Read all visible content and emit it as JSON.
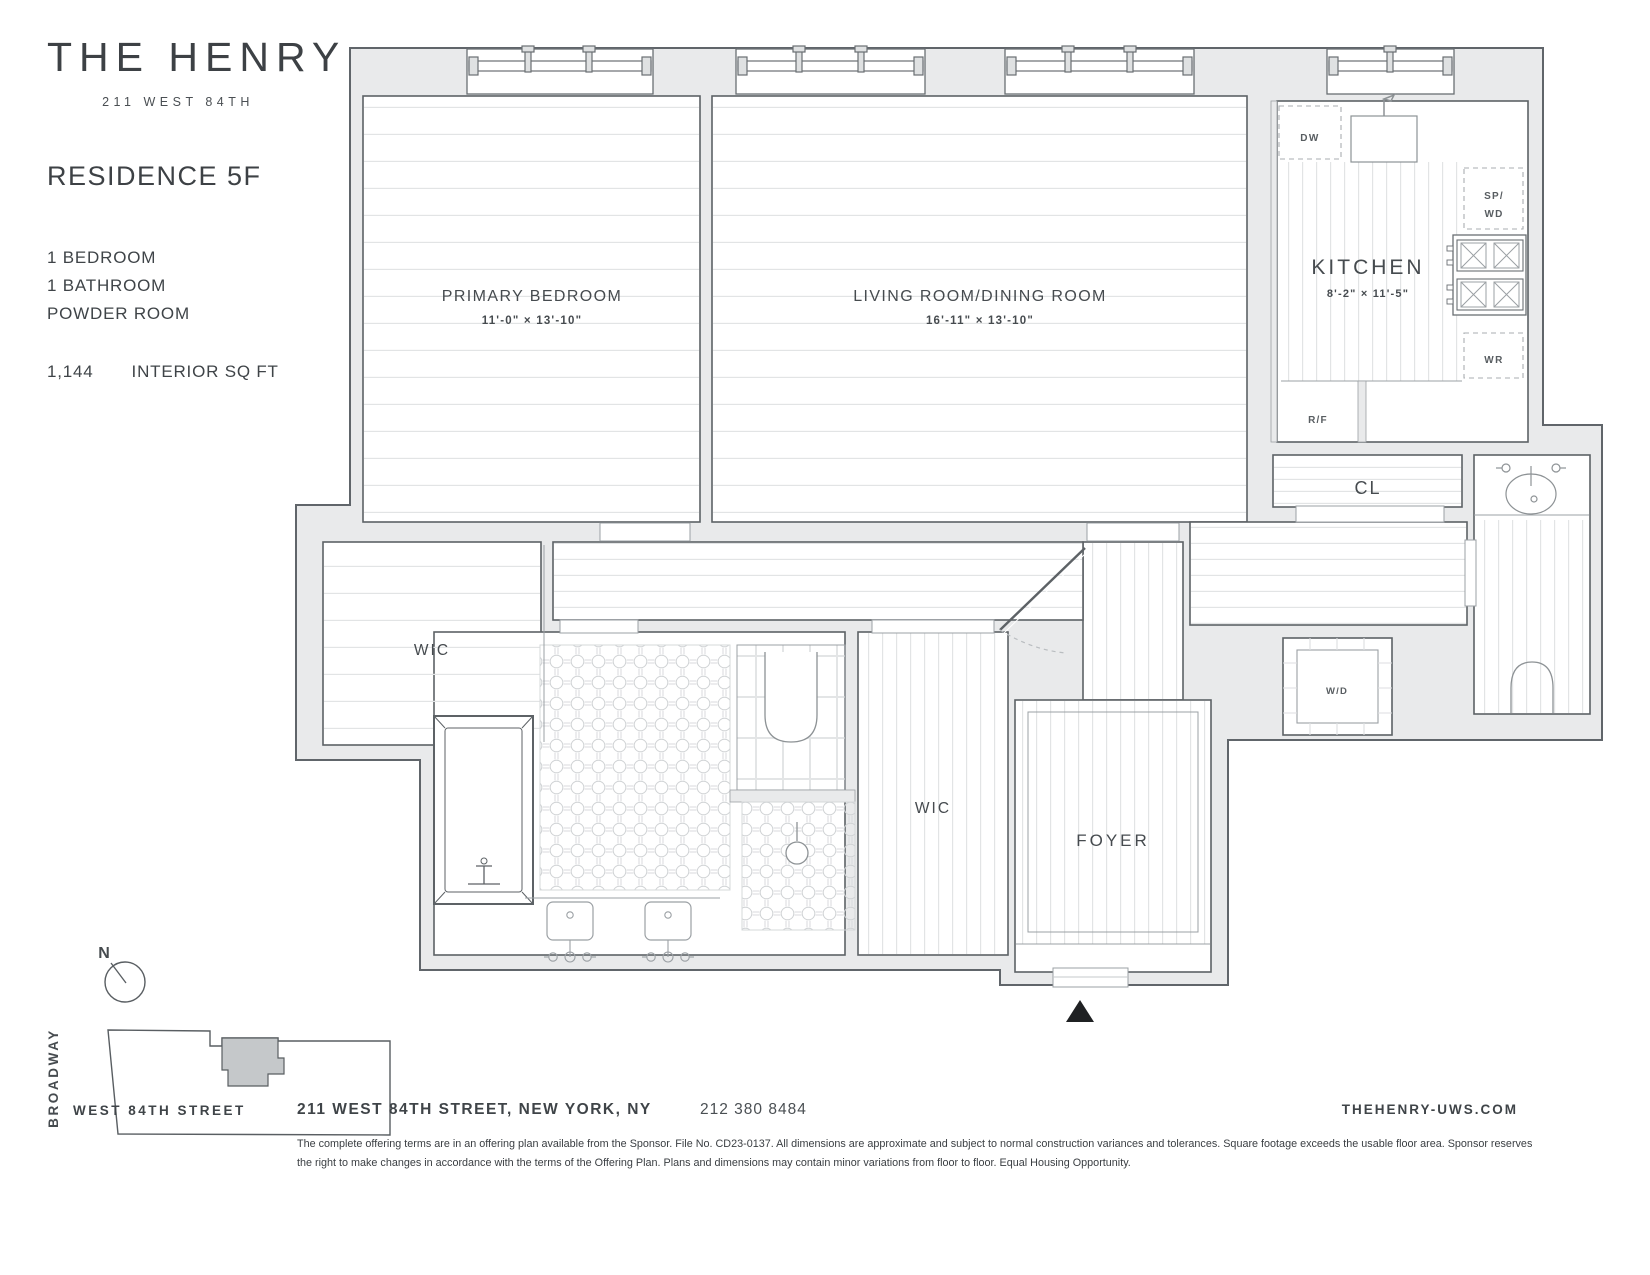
{
  "brand": {
    "name": "THE HENRY",
    "address": "211 WEST 84TH"
  },
  "residence": {
    "title": "RESIDENCE 5F",
    "features": [
      "1 BEDROOM",
      "1 BATHROOM",
      "POWDER ROOM"
    ],
    "area_value": "1,144",
    "area_label": "INTERIOR SQ FT"
  },
  "plan": {
    "primary_bedroom": {
      "label": "PRIMARY BEDROOM",
      "dims": "11'-0\" × 13'-10\""
    },
    "living": {
      "label": "LIVING ROOM/DINING ROOM",
      "dims": "16'-11\" × 13'-10\""
    },
    "kitchen": {
      "label": "KITCHEN",
      "dims": "8'-2\" × 11'-5\""
    },
    "wic_left": "WIC",
    "wic_hall": "WIC",
    "closet": "CL",
    "foyer": "FOYER",
    "appliances": {
      "dw": "DW",
      "sp": "SP/",
      "wd_stacked": "WD",
      "wr": "WR",
      "rf": "R/F",
      "washer_dryer": "W/D"
    }
  },
  "map": {
    "north": "N",
    "street_vertical": "BROADWAY",
    "street_bottom": "WEST 84TH STREET"
  },
  "footer": {
    "address": "211 WEST 84TH STREET, NEW YORK, NY",
    "phone": "212 380 8484",
    "website": "THEHENRY-UWS.COM",
    "disclaimer": "The complete offering terms are in an offering plan available from the Sponsor. File No. CD23-0137. All dimensions are approximate and subject to normal construction variances and tolerances. Square footage exceeds the usable floor area. Sponsor reserves the right to make changes in accordance with the terms of the Offering Plan. Plans and dimensions may contain minor variations from floor to floor. Equal Housing Opportunity."
  },
  "colors": {
    "wall_poche": "#e9eaeb",
    "wall_line": "#60656a",
    "text": "#42474b",
    "floor_line": "#e2e4e5",
    "footprint_fill": "#c5c8ca"
  }
}
